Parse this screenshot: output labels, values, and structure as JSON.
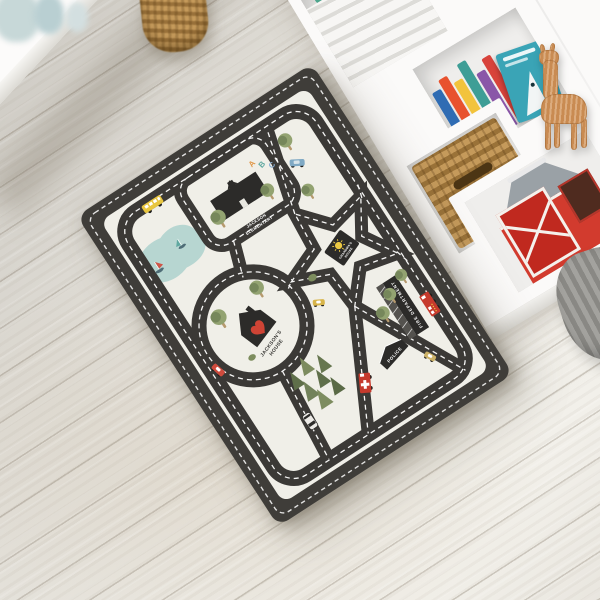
{
  "scene": {
    "description": "Personalized kids road-map play rug on a whitewashed wood floor, white cube shelves with books and toys behind",
    "colors": {
      "rug_base": "#3f3d39",
      "rug_field": "#f0efe8",
      "stitching": "#ffffff",
      "lake": "#b7d6d1",
      "heart_red": "#cf4435",
      "bus_yellow": "#e8c63f",
      "barn_red": "#d23b2e"
    },
    "rug": {
      "labels": {
        "school_line1": "JACKSON",
        "school_line2": "ELEMENTARY",
        "letters": [
          "A",
          "B",
          "C"
        ],
        "house_line1": "JACKSON'S",
        "house_line2": "HOUSE",
        "grandma_line1": "GRANDMA'S",
        "grandma_line2": "HOUSE",
        "fire": "FIRE DEPARTMENT",
        "police": "POLICE"
      }
    }
  }
}
